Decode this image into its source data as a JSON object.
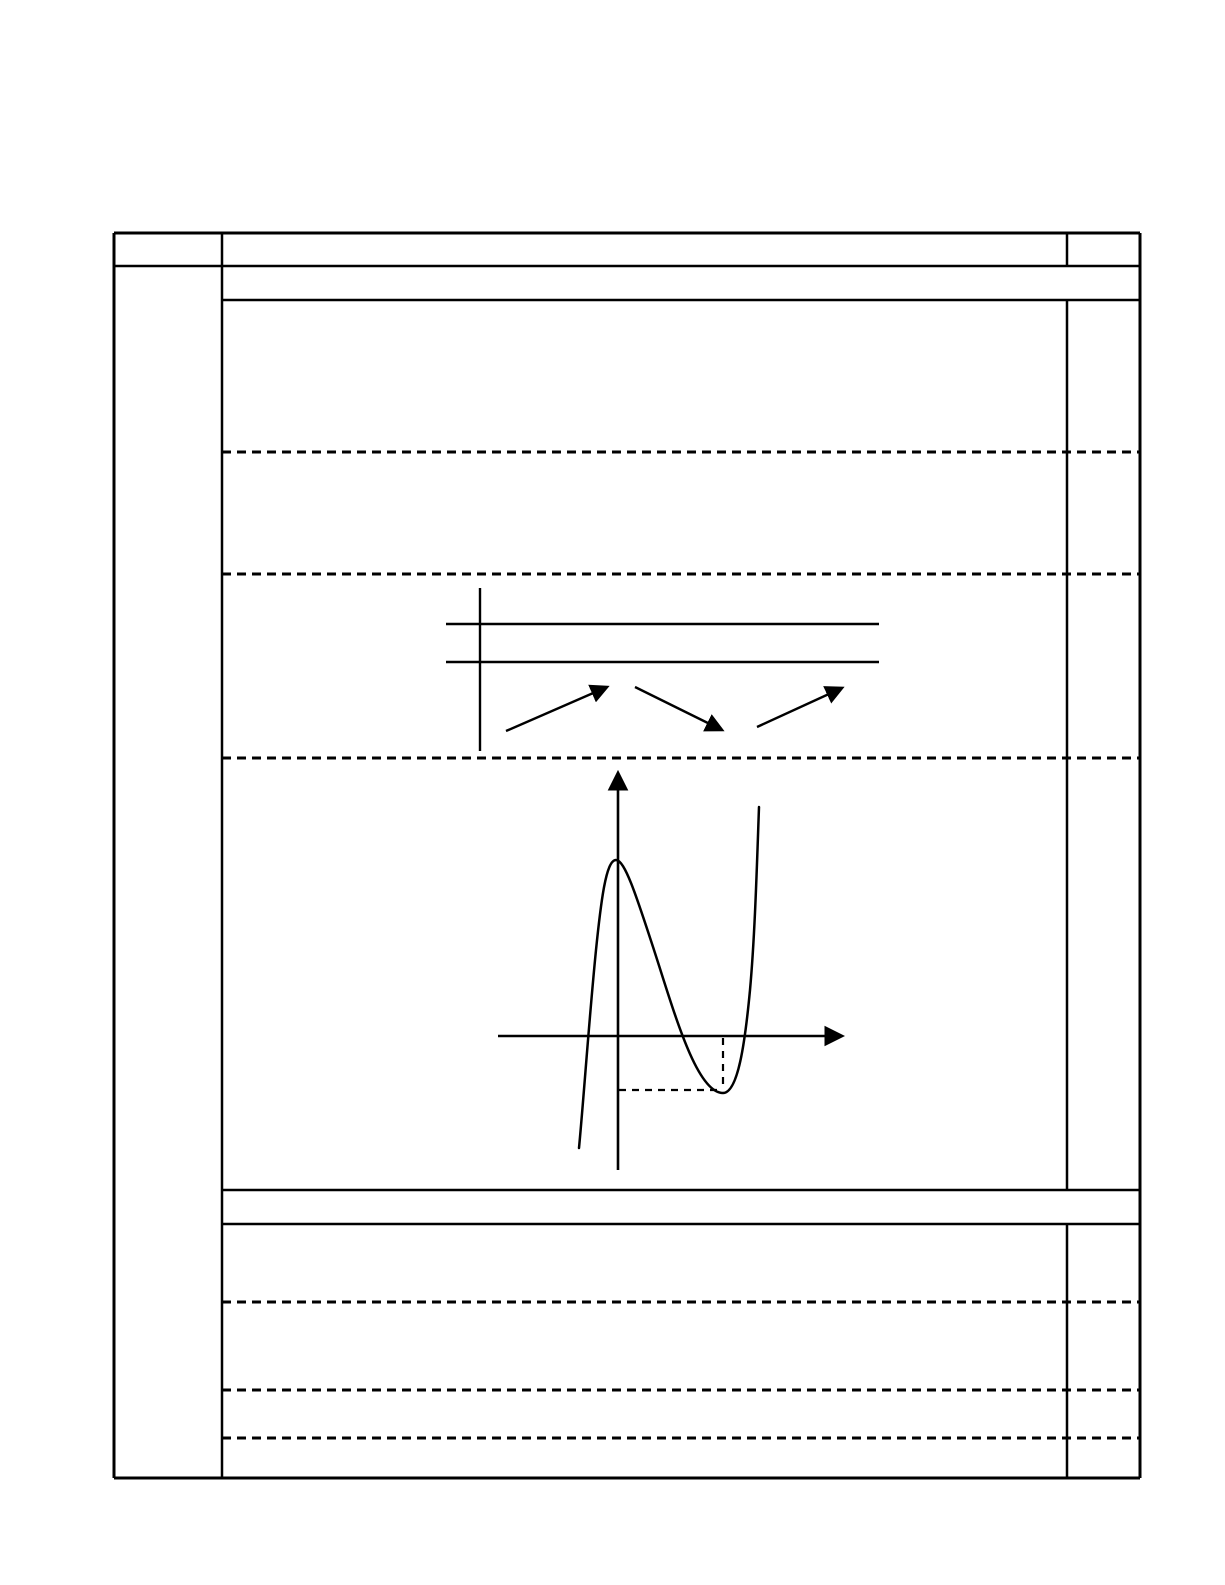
{
  "page": {
    "kind": "printed markscheme worksheet page (no text, table rules and hand-drawn figures only)",
    "background_color": "#ffffff",
    "ink_color": "#000000",
    "width_px": 1225,
    "height_px": 1585
  },
  "table": {
    "bounds": {
      "left": 114,
      "top": 233,
      "right": 1140,
      "bottom": 1478
    },
    "column_dividers_x": [
      222,
      1067
    ],
    "solid_lines": [
      {
        "name": "table-outer-top-border",
        "x1": 114,
        "y1": 233,
        "x2": 1140,
        "y2": 233,
        "w": 3
      },
      {
        "name": "table-outer-left-border",
        "x1": 114,
        "y1": 233,
        "x2": 114,
        "y2": 1478,
        "w": 3
      },
      {
        "name": "table-outer-right-border",
        "x1": 1140,
        "y1": 233,
        "x2": 1140,
        "y2": 1478,
        "w": 3
      },
      {
        "name": "table-outer-bottom-border",
        "x1": 114,
        "y1": 1478,
        "x2": 1140,
        "y2": 1478,
        "w": 3
      },
      {
        "name": "left-column-divider",
        "x1": 222,
        "y1": 233,
        "x2": 222,
        "y2": 1478,
        "w": 2.5
      },
      {
        "name": "header-row-bottom-rule",
        "x1": 114,
        "y1": 266,
        "x2": 1140,
        "y2": 266,
        "w": 2.5
      },
      {
        "name": "part-a-subheader-bottom-rule",
        "x1": 222,
        "y1": 300,
        "x2": 1140,
        "y2": 300,
        "w": 2.5
      },
      {
        "name": "marks-column-divider-header",
        "x1": 1067,
        "y1": 233,
        "x2": 1067,
        "y2": 266,
        "w": 2.5
      },
      {
        "name": "marks-column-divider-upper-block",
        "x1": 1067,
        "y1": 300,
        "x2": 1067,
        "y2": 1190,
        "w": 2.5
      },
      {
        "name": "part-b-top-rule",
        "x1": 222,
        "y1": 1190,
        "x2": 1140,
        "y2": 1190,
        "w": 2.5
      },
      {
        "name": "part-b-subheader-bottom-rule",
        "x1": 222,
        "y1": 1224,
        "x2": 1140,
        "y2": 1224,
        "w": 2.5
      },
      {
        "name": "marks-column-divider-lower-block",
        "x1": 1067,
        "y1": 1224,
        "x2": 1067,
        "y2": 1478,
        "w": 2.5
      }
    ],
    "dashed_row_separators_y": [
      452,
      574,
      758,
      1302,
      1390,
      1438
    ],
    "dashed_span": {
      "x1": 222,
      "x2": 1140
    },
    "dash_pattern": "9 6",
    "dash_width": 3
  },
  "figures": {
    "sign_diagram": {
      "meaning": "derivative sign / variation table: increasing, then decreasing, then increasing",
      "axis_line": {
        "x": 480,
        "y1": 588,
        "y2": 751
      },
      "row_lines": [
        {
          "name": "sign-table-upper-rule",
          "x1": 446,
          "y1": 624,
          "x2": 879,
          "y2": 624
        },
        {
          "name": "sign-table-lower-rule",
          "x1": 446,
          "y1": 662,
          "x2": 879,
          "y2": 662
        }
      ],
      "trend_arrows": [
        {
          "x1": 506,
          "y1": 731,
          "x2": 607,
          "y2": 687,
          "trend": "increasing"
        },
        {
          "x1": 635,
          "y1": 687,
          "x2": 722,
          "y2": 730,
          "trend": "decreasing"
        },
        {
          "x1": 757,
          "y1": 727,
          "x2": 842,
          "y2": 688,
          "trend": "increasing"
        }
      ]
    },
    "graph": {
      "meaning": "hand-drawn cubic curve: local maximum on the y-axis above the x-axis, local minimum below the x-axis to the right, dashed guide lines marking the minimum point",
      "y_axis": {
        "x": 618,
        "y1": 1170,
        "y2": 773
      },
      "x_axis": {
        "y": 1036,
        "x1": 498,
        "x2": 842
      },
      "curve_path": "M 579 1148 C 584 1095 589 1020 596 950 C 601 901 606 860 616 860 C 625 860 637 898 654 950 C 673 1008 696 1093 723 1093 C 738 1093 745 1043 750 990 C 755 935 757 862 759 807",
      "local_max_px": {
        "x": 616,
        "y": 860
      },
      "local_min_px": {
        "x": 723,
        "y": 1093
      },
      "x_intercepts_px": [
        586,
        689,
        743
      ],
      "dashed_guides": [
        {
          "name": "min-point-vertical-guide",
          "x1": 723,
          "y1": 1038,
          "x2": 723,
          "y2": 1090
        },
        {
          "name": "min-point-horizontal-guide",
          "x1": 619,
          "y1": 1090,
          "x2": 720,
          "y2": 1090
        }
      ],
      "guide_dash_pattern": "7 6"
    }
  }
}
